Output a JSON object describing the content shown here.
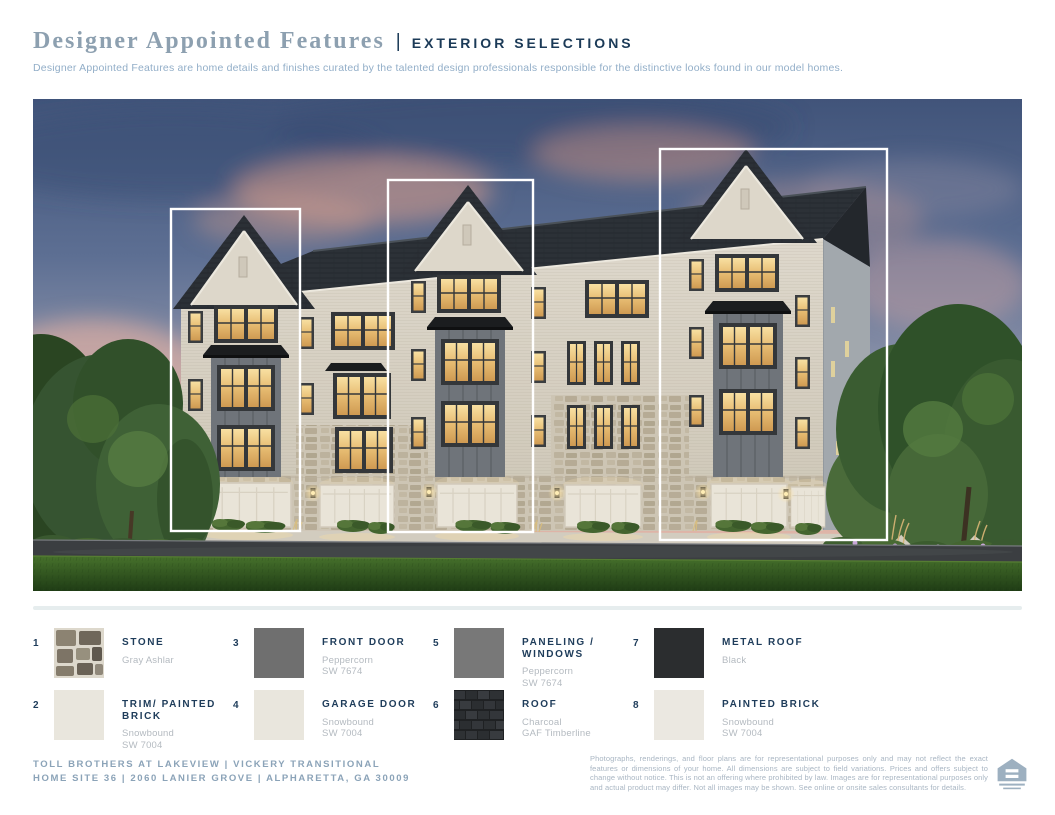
{
  "header": {
    "title": "Designer Appointed Features",
    "divider": "|",
    "section_label": "EXTERIOR SELECTIONS",
    "description": "Designer Appointed Features are home details and finishes curated by the talented design professionals responsible for the distinctive looks found in our model homes."
  },
  "hero": {
    "description": "Dusk rendering of three-story brick townhomes with three white callout rectangles highlighting individual units"
  },
  "legend": {
    "items": [
      {
        "number": "1",
        "name": "STONE",
        "line1": "Gray Ashlar",
        "line2": "",
        "swatch": "stone-texture"
      },
      {
        "number": "2",
        "name": "TRIM/ PAINTED BRICK",
        "line1": "Snowbound",
        "line2": "SW 7004",
        "swatch_color": "#e9e6dd"
      },
      {
        "number": "3",
        "name": "FRONT DOOR",
        "line1": "Peppercorn",
        "line2": "SW 7674",
        "swatch_color": "#6f6f6f"
      },
      {
        "number": "4",
        "name": "GARAGE DOOR",
        "line1": "Snowbound",
        "line2": "SW 7004",
        "swatch_color": "#e9e6dd"
      },
      {
        "number": "5",
        "name": "PANELING / WINDOWS",
        "line1": "Peppercorn",
        "line2": "SW 7674",
        "swatch_color": "#787878"
      },
      {
        "number": "6",
        "name": "ROOF",
        "line1": "Charcoal",
        "line2": "GAF Timberline",
        "swatch": "shingle-texture"
      },
      {
        "number": "7",
        "name": "METAL ROOF",
        "line1": "Black",
        "line2": "",
        "swatch_color": "#2b2d2f"
      },
      {
        "number": "8",
        "name": "PAINTED BRICK",
        "line1": "Snowbound",
        "line2": "SW 7004",
        "swatch_color": "#ebe8e1"
      }
    ]
  },
  "footer": {
    "line1": "TOLL BROTHERS AT LAKEVIEW | VICKERY TRANSITIONAL",
    "line2": "HOME SITE 36 | 2060 LANIER GROVE | ALPHARETTA, GA 30009",
    "disclaimer": "Photographs, renderings, and floor plans are for representational purposes only and may not reflect the exact features or dimensions of your home. All dimensions are subject to field variations. Prices and offers subject to change without notice. This is not an offering where prohibited by law. Images are for representational purposes only and actual product may differ. Not all images may be shown. See online or onsite sales consultants for details."
  },
  "colors": {
    "accent_navy": "#1b3a57",
    "title_slate": "#8da0b0",
    "muted_blue": "#92aec8",
    "footer_blue": "#8ba3b8",
    "sublabel_gray": "#b4bac0",
    "divider_gray": "#e6edee",
    "callout_white": "#ffffff"
  }
}
